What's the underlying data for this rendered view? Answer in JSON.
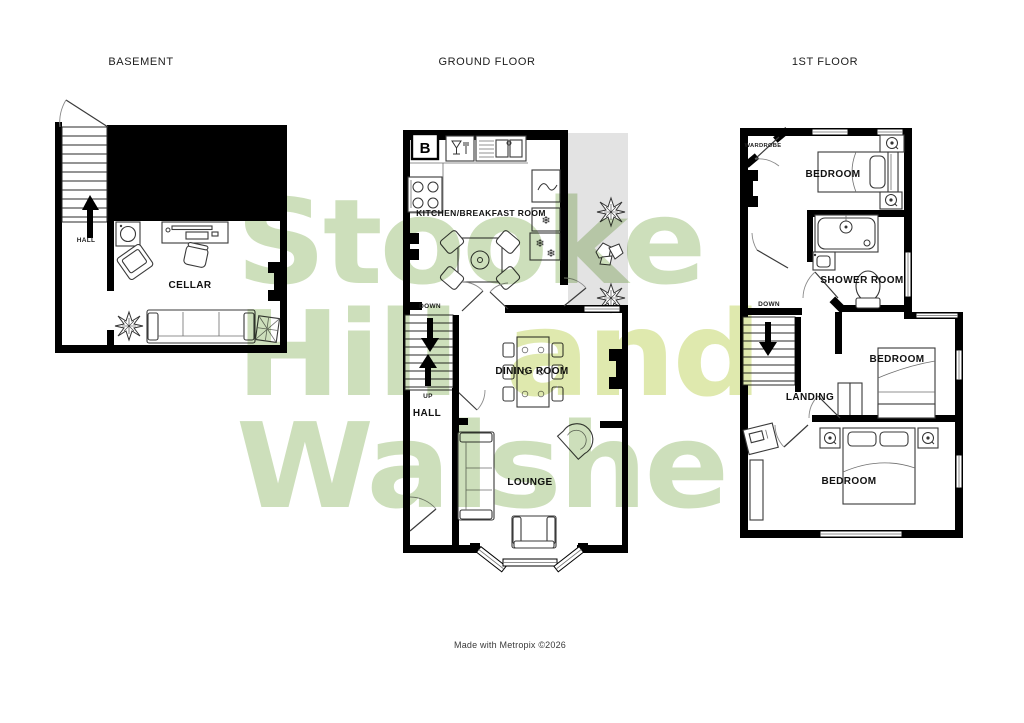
{
  "titles": {
    "basement": "BASEMENT",
    "ground": "GROUND FLOOR",
    "first": "1ST FLOOR"
  },
  "watermark": {
    "word1": "Stooke",
    "word2": "Hill",
    "word3": "and",
    "word4": "Walshe"
  },
  "footer": {
    "text": "Made with Metropix ©2026"
  },
  "basement": {
    "hall": "HALL",
    "cellar": "CELLAR"
  },
  "ground": {
    "kitchen": "KITCHEN/BREAKFAST ROOM",
    "dining": "DINING ROOM",
    "lounge": "LOUNGE",
    "hall": "HALL",
    "down": "DOWN",
    "up": "UP",
    "boiler": "B"
  },
  "first": {
    "bedroom1": "BEDROOM",
    "shower": "SHOWER ROOM",
    "bedroom2": "BEDROOM",
    "bedroom3": "BEDROOM",
    "landing": "LANDING",
    "wardrobe": "WARDROBE",
    "down": "DOWN"
  },
  "icons": {
    "snowflake": "❄"
  },
  "colors": {
    "wall": "#000000",
    "outdoor_area": "#e3e3e3",
    "watermark_green": "#cddfbb",
    "watermark_accent": "#dfe9ae"
  }
}
